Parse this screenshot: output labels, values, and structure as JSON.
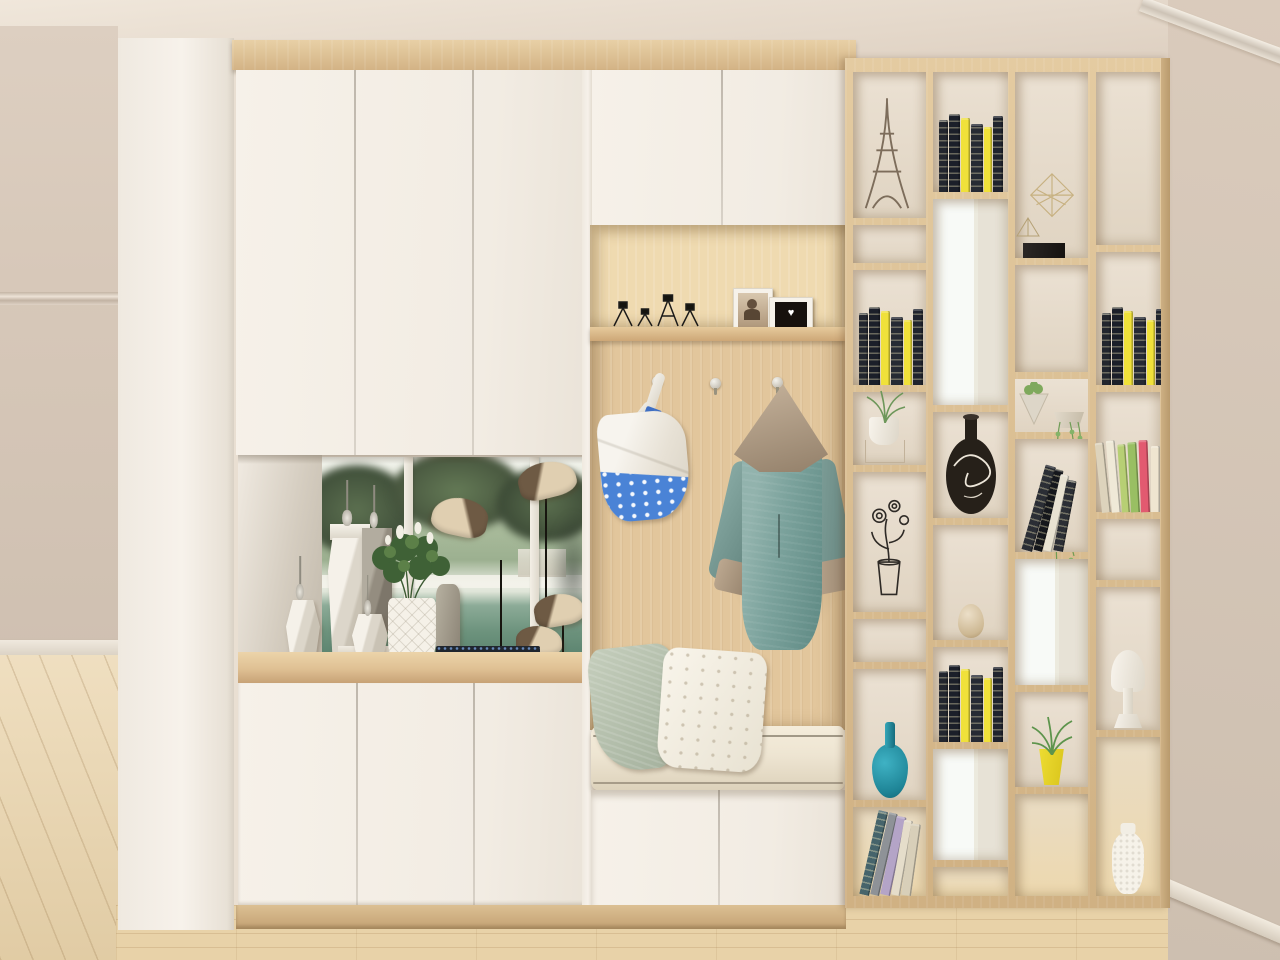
{
  "palette": {
    "ceiling": "#ece2d5",
    "wall_left": "#d4c5b6",
    "wall_right": "#d2c3b4",
    "cabinet_white": "#f4efe7",
    "wood": "#dfc49a",
    "wood_dark": "#c7a678",
    "floor": "#e8d2a8",
    "mirror_green": "#8fa98c",
    "bag_blue": "#4a83d6",
    "coat_teal": "#7ca49e",
    "coat_beige": "#b2a08b",
    "pillow_sage": "#b8c2af",
    "pillow_white": "#f4efe3",
    "cushion": "#ece3d1",
    "vase_teal": "#259aad",
    "book_dark": "#22262f",
    "book_yellow": "#f0e13a",
    "plant_green": "#6d9a58",
    "planter_yellow": "#e8d829",
    "decor_white": "#f6f2ea",
    "metal_grey": "#b5afa2"
  },
  "icons": {
    "heart": "♥"
  },
  "objects": {
    "display_shelf": [
      {
        "id": "faceted-vase-small",
        "label": "small white faceted vase"
      },
      {
        "id": "faceted-vase-tall",
        "label": "tall white faceted vase"
      },
      {
        "id": "grey-column-vase",
        "label": "grey faceted column vase"
      },
      {
        "id": "spire-bottle",
        "label": "silver spire perfume bottle"
      },
      {
        "id": "diamond-planter",
        "label": "white diamond-pattern planter with flowers"
      },
      {
        "id": "grey-vase",
        "label": "grey vase"
      },
      {
        "id": "bird-sculpture",
        "label": "beige bird sculpture on stick"
      },
      {
        "id": "speckle-mat",
        "label": "dark speckled tray"
      }
    ],
    "coat_area": [
      {
        "id": "wire-candleholder",
        "label": "black wire candle holder"
      },
      {
        "id": "photo-frame-portrait",
        "label": "white frame with portrait photo"
      },
      {
        "id": "photo-frame-heart",
        "label": "white frame with heart photo"
      },
      {
        "id": "wall-hook",
        "label": "round metal coat hook"
      },
      {
        "id": "tote-bag",
        "label": "white tote bag with blue pattern"
      },
      {
        "id": "hooded-coat",
        "label": "teal coat with beige hood"
      }
    ],
    "bench": [
      {
        "id": "pillow-sage",
        "label": "sage green pillow"
      },
      {
        "id": "pillow-dotted",
        "label": "white dotted pillow"
      },
      {
        "id": "bench-cushion",
        "label": "cream bench cushion"
      }
    ],
    "bookshelf": [
      {
        "id": "eiffel-tower-figurine",
        "label": "Eiffel tower sketch figurine"
      },
      {
        "id": "black-yellow-books",
        "label": "black books with yellow spines"
      },
      {
        "id": "potted-plant-on-stand",
        "label": "white potted plant on wire stand"
      },
      {
        "id": "wire-flower-sculpture",
        "label": "black wire flower sculpture"
      },
      {
        "id": "teal-vase",
        "label": "teal teardrop vase"
      },
      {
        "id": "leaning-books",
        "label": "leaning books"
      },
      {
        "id": "black-swirl-vase",
        "label": "black vase with white swirls"
      },
      {
        "id": "stone-egg",
        "label": "stone egg ornament"
      },
      {
        "id": "wireframe-sculpture",
        "label": "gold wireframe sculpture and black box"
      },
      {
        "id": "succulent-and-vine",
        "label": "cone succulent planter and hanging vine"
      },
      {
        "id": "leaning-bw-books",
        "label": "leaning black and white books"
      },
      {
        "id": "yellow-planter-plant",
        "label": "yellow planter with green plant"
      },
      {
        "id": "colorful-books-row",
        "label": "row of colorful books"
      },
      {
        "id": "white-pedestal-vase",
        "label": "white pedestal vase"
      },
      {
        "id": "white-textured-vase",
        "label": "white textured vase"
      }
    ]
  }
}
